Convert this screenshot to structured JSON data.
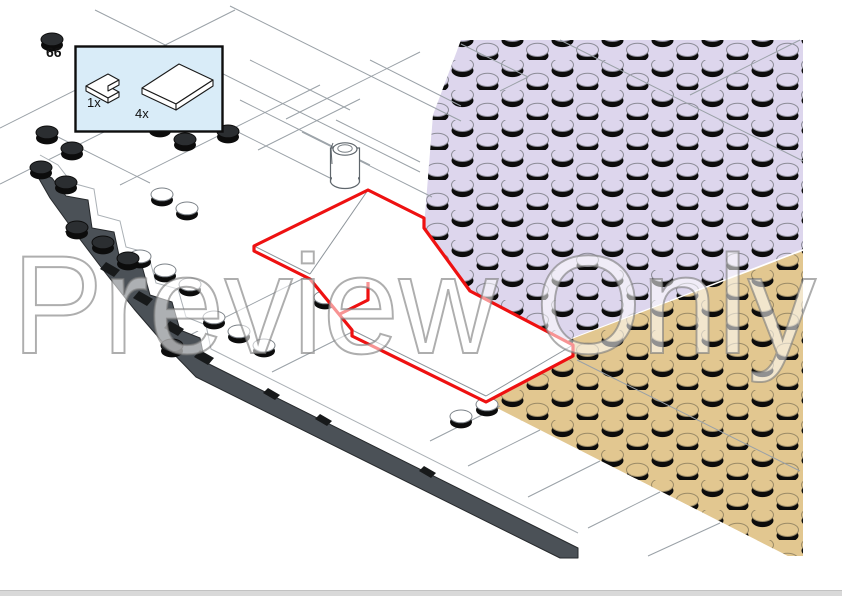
{
  "page": {
    "step_number": "66",
    "watermark_text": "Preview Only"
  },
  "parts_box": {
    "items": [
      {
        "qty": "1x",
        "part": "corner-plate"
      },
      {
        "qty": "4x",
        "part": "rectangular-plate"
      }
    ]
  },
  "figure": {
    "description_labels": {
      "lavender_baseplate": "studded baseplate (lavender)",
      "tan_baseplate": "studded baseplate (tan)",
      "highlight": "new parts outlined in red"
    }
  },
  "colors": {
    "lavender_plate": "#ddd6ed",
    "tan_plate": "#e2c790",
    "highlight_red": "#ee1111",
    "hull_gray": "#4b5157",
    "parts_box_fill": "#d9ecf8",
    "page_edge_bar": "#d9d9d9"
  }
}
